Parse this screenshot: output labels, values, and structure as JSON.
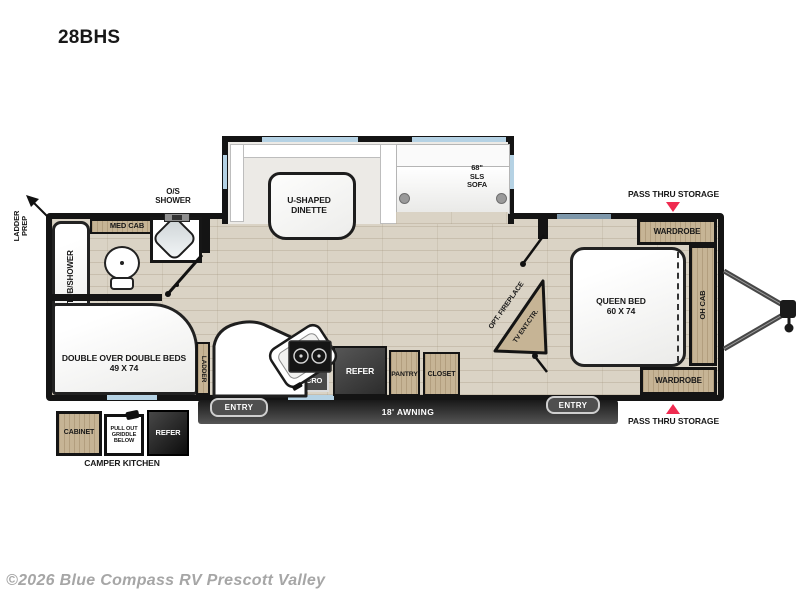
{
  "model": "28BHS",
  "watermark": "©2026 Blue Compass RV Prescott Valley",
  "colors": {
    "accent_red": "#ef2b50",
    "wall_black": "#141414",
    "cabinet_wood": "#c6b495",
    "floor_wood": "#dad3c5",
    "window_blue": "#b5d2e4"
  },
  "exterior": {
    "ladder_prep": "LADDER\nPREP",
    "os_shower": "O/S\nSHOWER",
    "pass_thru_storage": "PASS THRU STORAGE",
    "awning": "18' AWNING",
    "entry": "ENTRY"
  },
  "camper_kitchen": {
    "cabinet": "CABINET",
    "griddle": "PULL OUT\nGRIDDLE\nBELOW",
    "refer": "REFER",
    "caption": "CAMPER KITCHEN"
  },
  "bathroom": {
    "tub_shower": "TUB/SHOWER",
    "med_cab": "MED CAB"
  },
  "bunk_room": {
    "beds": "DOUBLE OVER DOUBLE BEDS\n49 X 74",
    "ladder": "LADDER"
  },
  "kitchen": {
    "oh_cab": "OH CAB",
    "micro": "MICRO",
    "refer": "REFER",
    "pantry": "PANTRY",
    "closet": "CLOSET"
  },
  "living": {
    "dinette": "U-SHAPED\nDINETTE",
    "sofa": "68\"\nSLS\nSOFA",
    "opt_fireplace": "OPT. FIREPLACE",
    "tv_ent_ctr": "TV ENT.CTR."
  },
  "bedroom": {
    "queen_bed": "QUEEN BED\n60 X 74",
    "wardrobe": "WARDROBE",
    "oh_cab": "OH CAB"
  }
}
